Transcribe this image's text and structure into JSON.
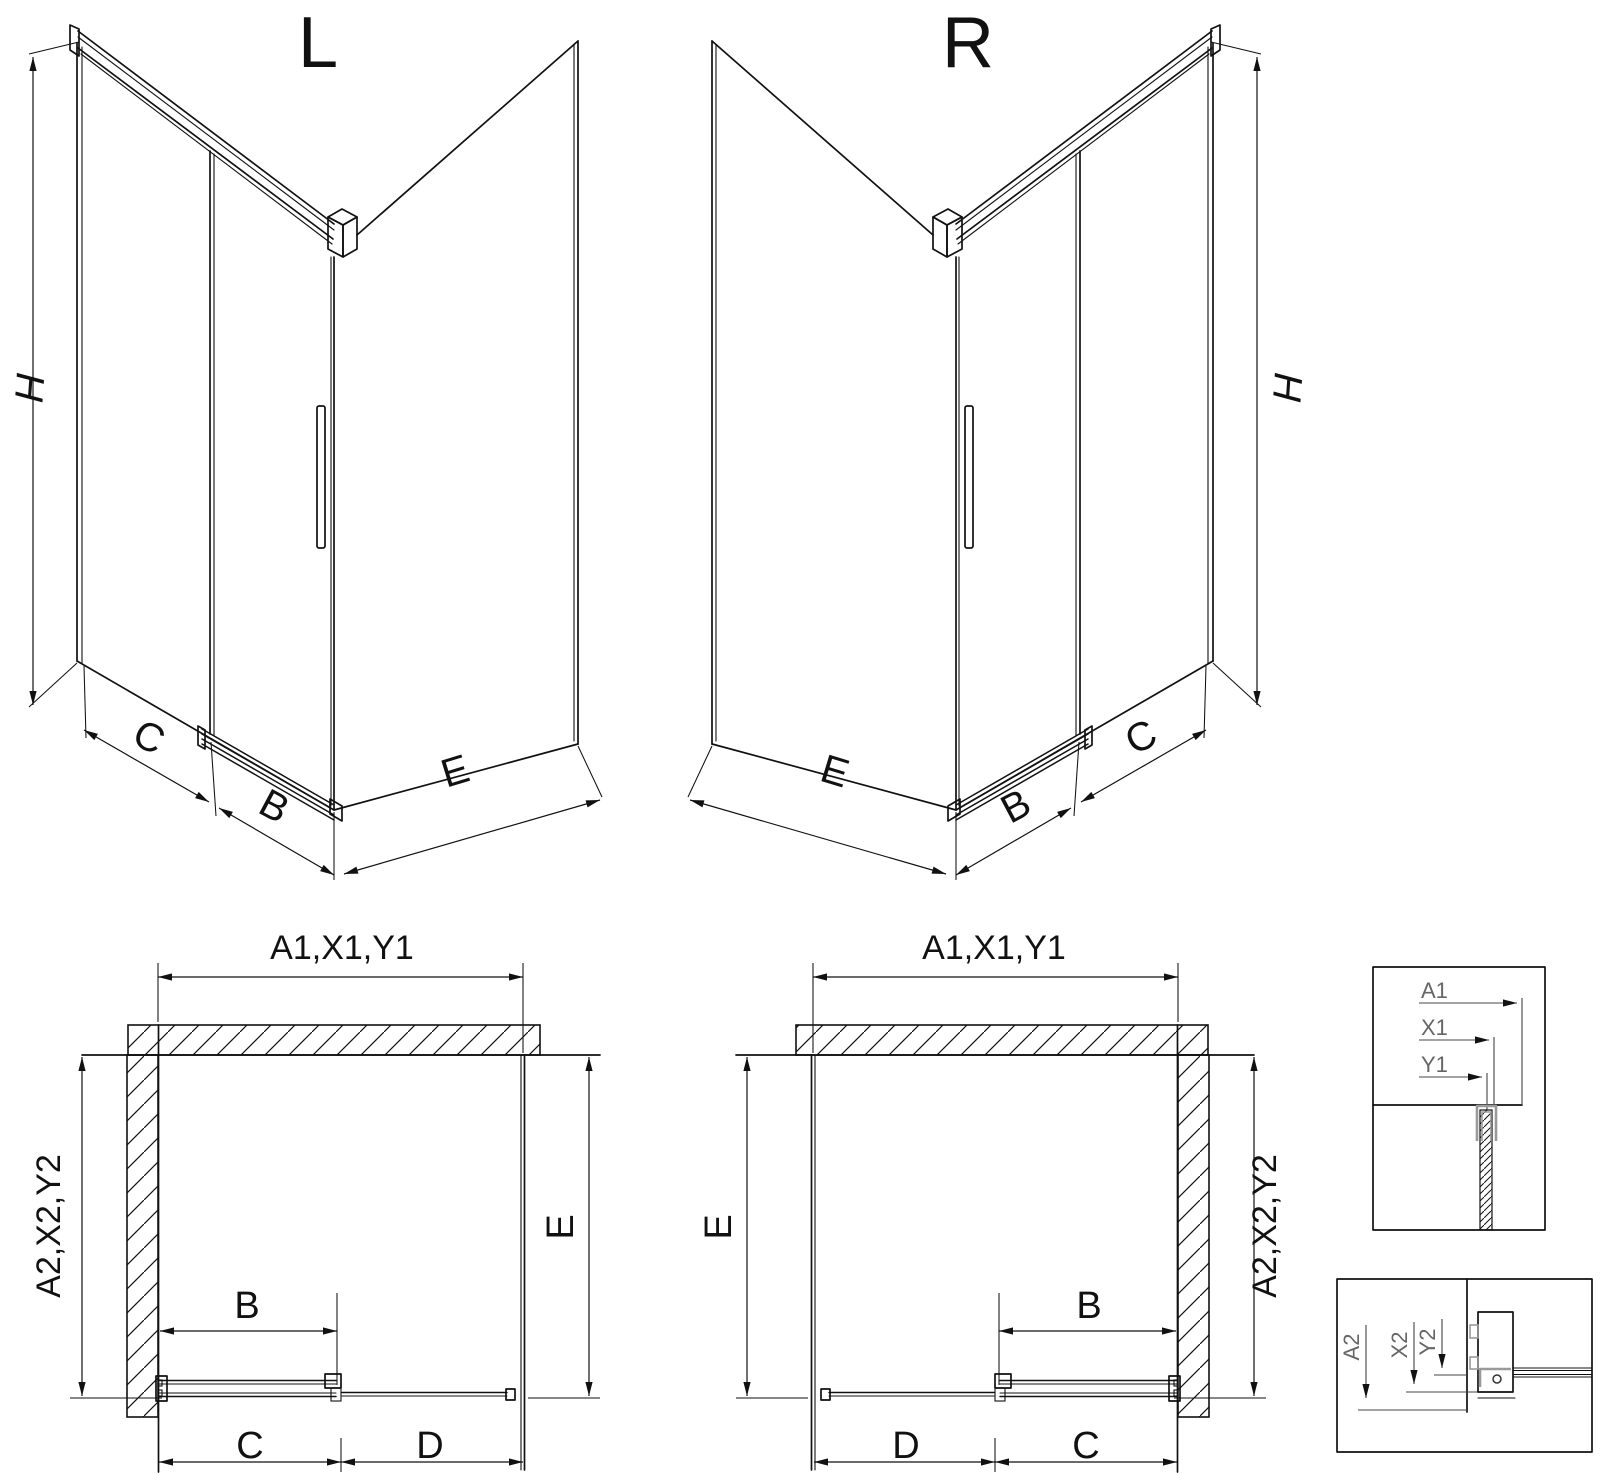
{
  "iso_left": {
    "title": "L",
    "h": "H",
    "c": "C",
    "b": "B",
    "e": "E"
  },
  "iso_right": {
    "title": "R",
    "h": "H",
    "c": "C",
    "b": "B",
    "e": "E"
  },
  "plan_left": {
    "top": "A1,X1,Y1",
    "side": "A2,X2,Y2",
    "e": "E",
    "b": "B",
    "c": "C",
    "d": "D"
  },
  "plan_right": {
    "top": "A1,X1,Y1",
    "side": "A2,X2,Y2",
    "e": "E",
    "b": "B",
    "c": "C",
    "d": "D"
  },
  "detail_top": {
    "a1": "A1",
    "x1": "X1",
    "y1": "Y1"
  },
  "detail_bottom": {
    "a2": "A2",
    "x2": "X2",
    "y2": "Y2"
  },
  "colors": {
    "line": "#111111",
    "profile_gray": "#9a9a9a",
    "detail_label": "#666666",
    "background": "#ffffff"
  }
}
